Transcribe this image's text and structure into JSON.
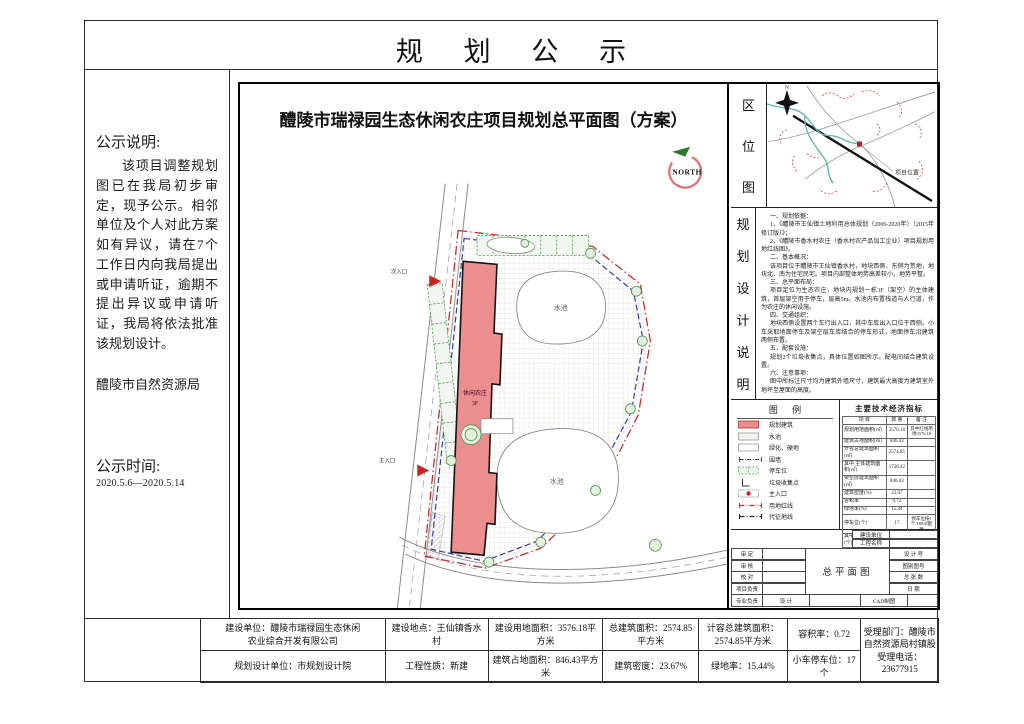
{
  "page": {
    "title": "规  划  公  示"
  },
  "notice": {
    "heading": "公示说明:",
    "body": "该项目调整规划图已在我局初步审定，现予公示。相邻单位及个人对此方案如有异议，请在7个工作日内向我局提出或申请听证，逾期不提出异议或申请听证，我局将依法批准该规划设计。",
    "agency": "醴陵市自然资源局",
    "time_heading": "公示时间:",
    "time_range": "2020.5.6—2020.5.14"
  },
  "plan": {
    "title": "醴陵市瑞禄园生态休闲农庄项目规划总平面图（方案）",
    "north_label": "NORTH",
    "building_label": "休闲农庄",
    "building_floors": "3F",
    "pond_label": "水池",
    "entrance_main": "主入口",
    "entrance_secondary": "次入口"
  },
  "location_map": {
    "label_chars": [
      "区",
      "位",
      "图"
    ],
    "north_letter": "N",
    "project_label": "项目位置"
  },
  "design_notes": {
    "label_chars": [
      "规",
      "划",
      "设",
      "计",
      "说",
      "明"
    ],
    "paragraphs": [
      "一、规划依据：",
      "1、《醴陵市王仙镇土地利用总体规划（2006-2020年）（2015年修订版）》；",
      "2、《醴陵市香水村农庄（香水村农产品加工企业）项目规划用地红线图》。",
      "二、基本概况：",
      "该项目位于醴陵市王仙镇香水村，地块西侧、东侧为荒地，地块北、南为住宅民宅。项目内部整体地势高差较小，地势平整。",
      "三、总平面布局：",
      "项目定位为生态农庄，地块内规划一栋3F（架空）的主体建筑，首层架空用于停车，层高5m。水池内布置栈道与人行道，作为农庄的休闲设施。",
      "四、交通组织：",
      "地块西侧设置两个车行出入口，其中车库出入口位于西侧。小车采取地面停车及架空层车库结合的停车形式，地面停车沿建筑两侧布置。",
      "五、配套设施：",
      "规划2个垃圾收集点，具体位置如图所示。配电间结合建筑设置。",
      "六、注意事项：",
      "图中所标注尺寸均为建筑外墙尺寸，建筑最大高度为建筑室外地坪至屋面的高度。"
    ]
  },
  "legend": {
    "title": "图 例",
    "items": [
      {
        "label": "规划建筑"
      },
      {
        "label": "水池"
      },
      {
        "label": "绿化、硬地"
      },
      {
        "label": "围墙"
      },
      {
        "label": "停车位"
      },
      {
        "label": "垃圾收集点"
      },
      {
        "label": "主入口"
      },
      {
        "label": "用地红线"
      },
      {
        "label": "代征地线"
      }
    ]
  },
  "indicators": {
    "title": "主要技术经济指标",
    "headers": [
      "项  目",
      "数  量",
      "备  注"
    ],
    "rows": [
      [
        "规划用地面积(㎡)",
        "3576.18",
        "其中红线用地3576.18"
      ],
      [
        "建筑占地面积(㎡)",
        "846.43",
        ""
      ],
      [
        "计容总建筑面积(㎡)",
        "2574.85",
        ""
      ],
      [
        "其中 主体建筑面积(㎡)",
        "1728.42",
        ""
      ],
      [
        "架空层建筑面积(㎡)",
        "846.43",
        ""
      ],
      [
        "建筑密度(%)",
        "23.67",
        ""
      ],
      [
        "容积率",
        "0.72",
        ""
      ],
      [
        "绿地率(%)",
        "15.44",
        ""
      ],
      [
        "停车位(个)",
        "17",
        "停车位按1个/100㎡配建"
      ],
      [
        "其中 地面停车位(个)",
        "7",
        ""
      ],
      [
        "架空层停车位(个)",
        "10",
        ""
      ]
    ]
  },
  "title_block": {
    "owner_label": "建设单位",
    "project_label": "工程名称",
    "left_rows": [
      "审 定",
      "审 核",
      "校 对",
      "项目负责",
      "专业负责"
    ],
    "drawing_name": "总平面图",
    "right_rows": [
      "设 计 号",
      "图别图号",
      "总 张 数",
      "日 期"
    ],
    "design_label": "设 计",
    "cad_label": "CAD制图"
  },
  "bottom_table": {
    "r1c1": "建设单位：醴陵市瑞禄园生态休闲\n农业综合开发有限公司",
    "r1c2": "建设地点：王仙镇香水村",
    "r1c3": "建设用地面积：3576.18平方米",
    "r1c4": "总建筑面积：2574.85平方米",
    "r1c5": "计容总建筑面积：\n2574.85平方米",
    "r1c6": "容积率：0.72",
    "dept": "受理部门：醴陵市\n自然资源局村镇股\n受理电话：23677915",
    "r2c1": "规划设计单位：市规划设计院",
    "r2c2": "工程性质：新建",
    "r2c3": "建筑占地面积：846.43平方米",
    "r2c4": "建筑密度：23.67%",
    "r2c5": "绿地率：15.44%",
    "r2c6": "小车停车位：17个"
  }
}
